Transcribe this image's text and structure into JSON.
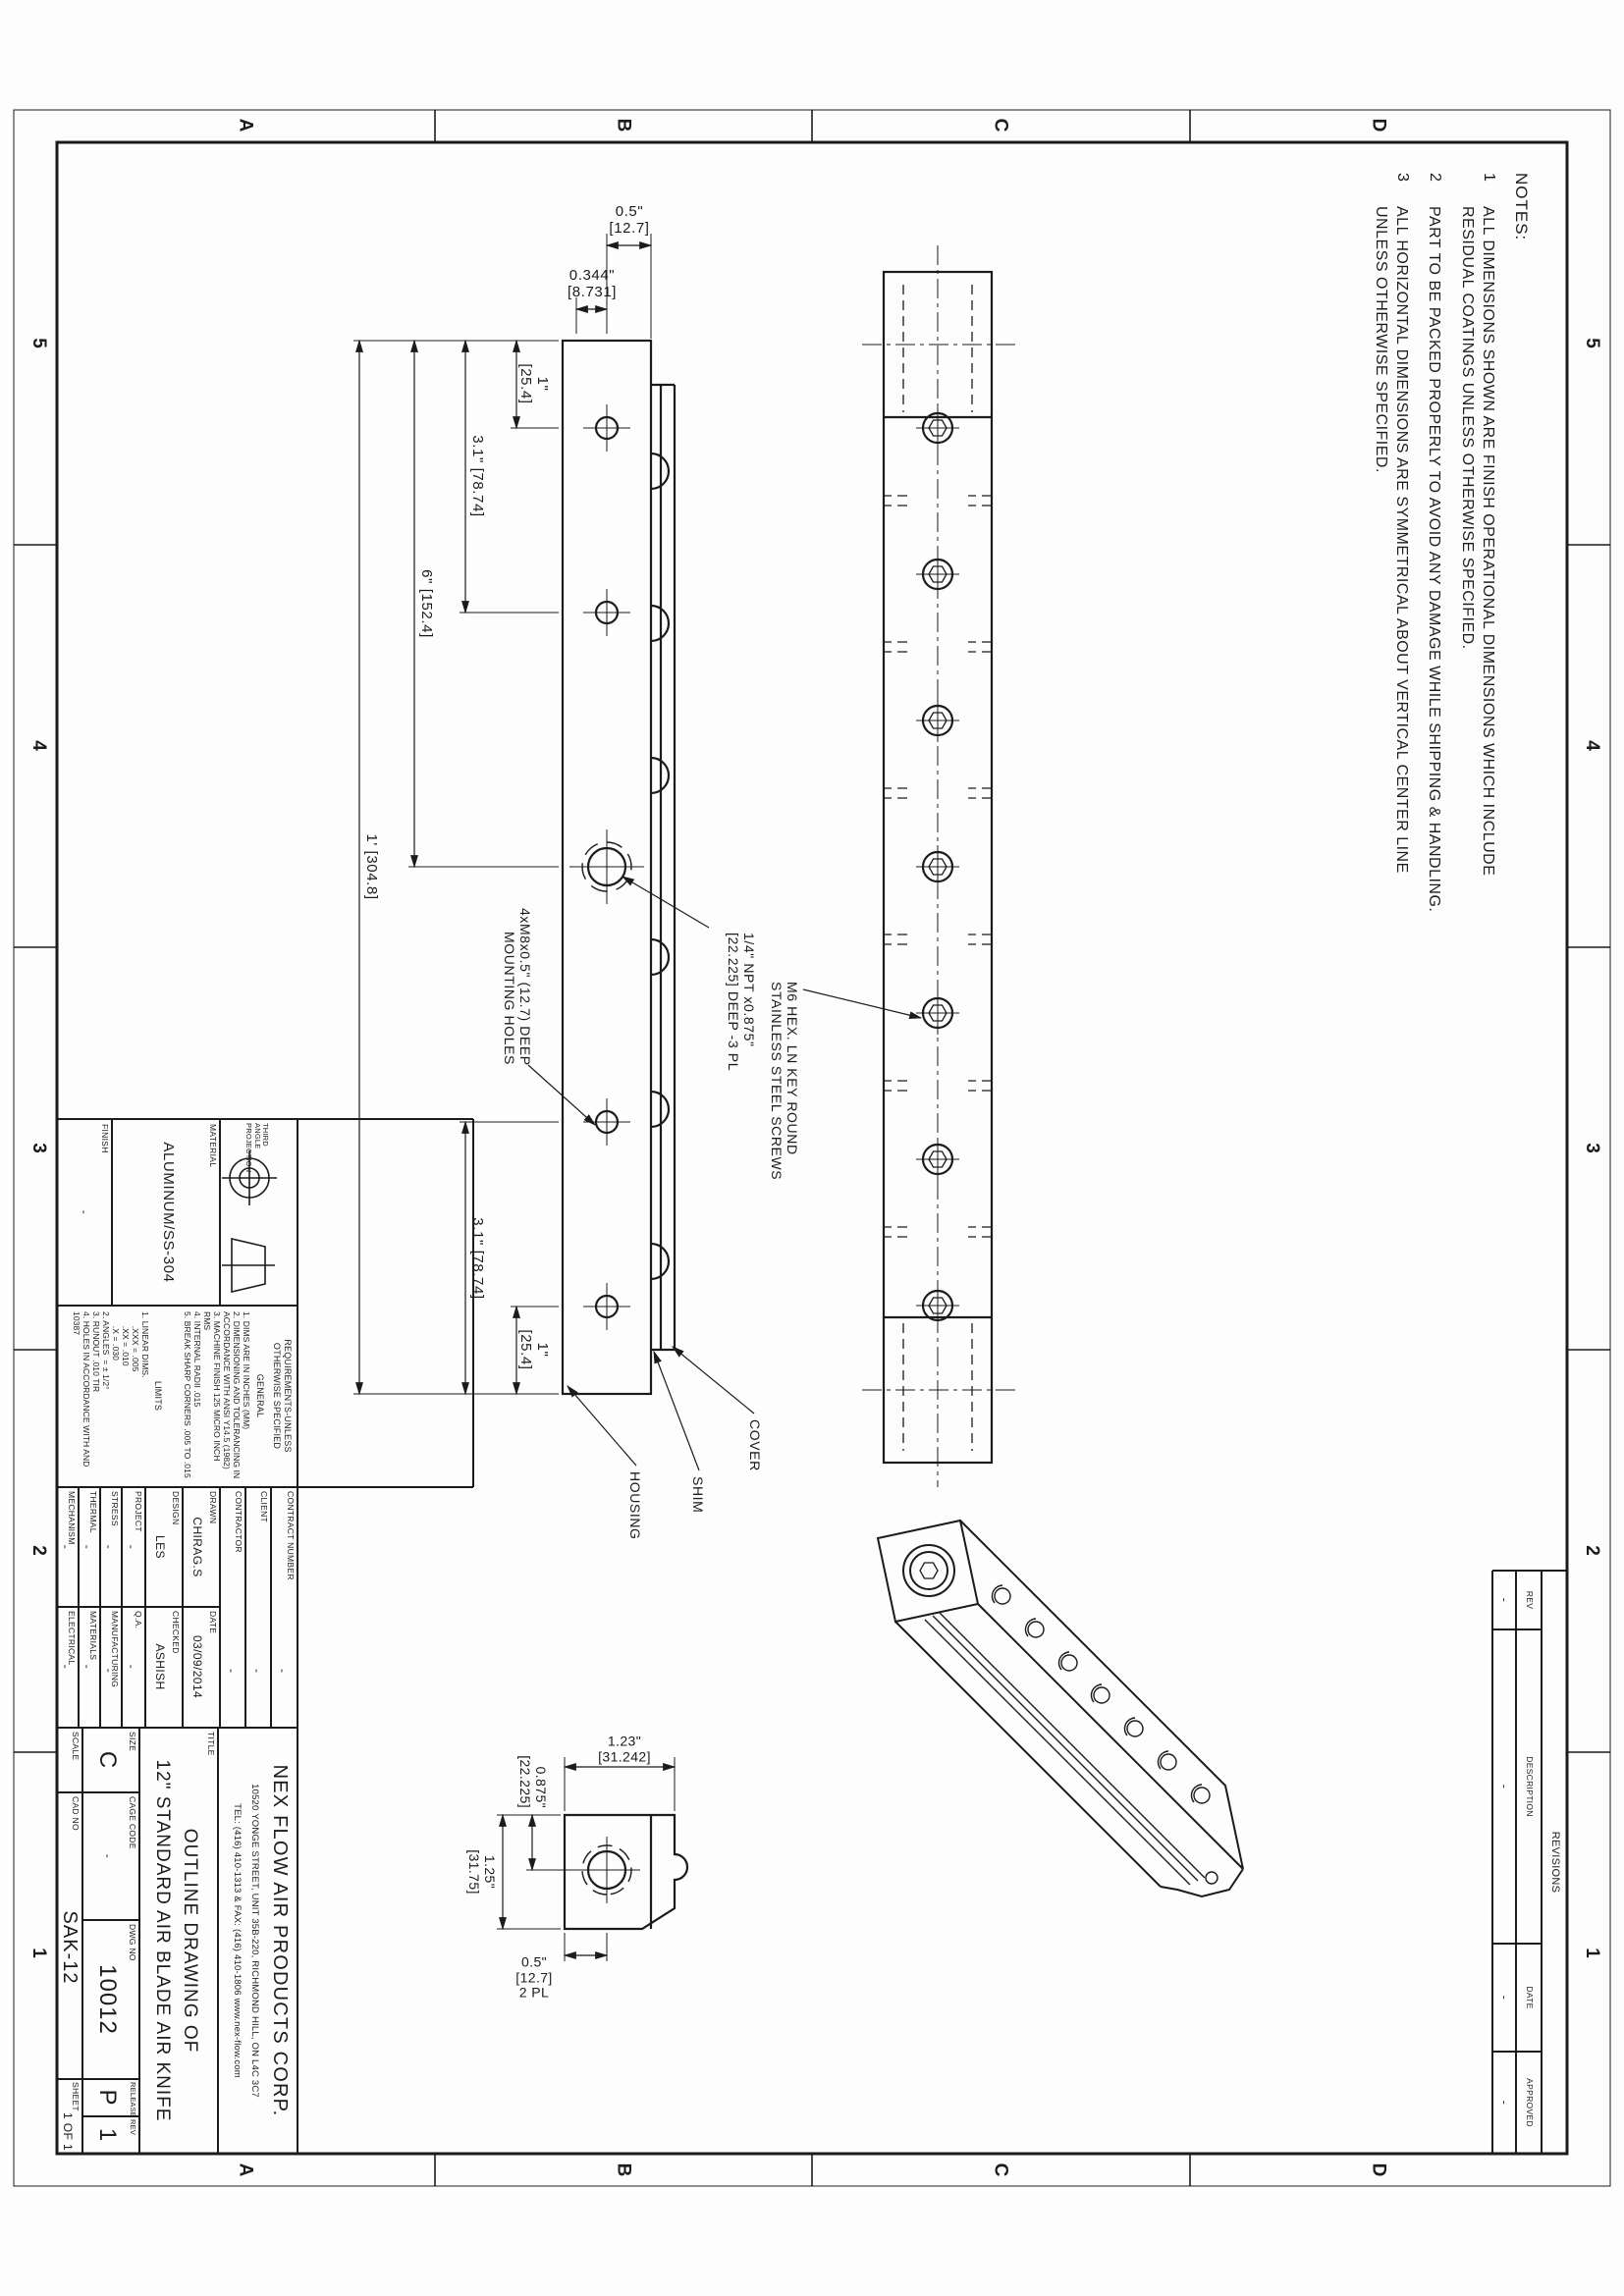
{
  "sheet": {
    "zone_columns": [
      "5",
      "4",
      "3",
      "2",
      "1"
    ],
    "zone_rows": [
      "D",
      "C",
      "B",
      "A"
    ]
  },
  "notes": {
    "title": "NOTES:",
    "items": [
      {
        "num": "1",
        "line1": "ALL DIMENSIONS SHOWN ARE FINISH OPERATIONAL DIMENSIONS WHICH INCLUDE",
        "line2": "RESIDUAL COATINGS UNLESS OTHERWISE SPECIFIED."
      },
      {
        "num": "2",
        "line1": "PART TO BE PACKED PROPERLY TO AVOID ANY DAMAGE WHILE SHIPPING & HANDLING.",
        "line2": ""
      },
      {
        "num": "3",
        "line1": "ALL HORIZONTAL DIMENSIONS ARE SYMMETRICAL ABOUT VERTICAL CENTER LINE",
        "line2": "UNLESS OTHERWISE SPECIFIED."
      }
    ]
  },
  "front_view": {
    "dims": {
      "one_a": "1\"",
      "one_b": "[25.4]",
      "three_one": "3.1\" [78.74]",
      "six": "6\" [152.4]",
      "foot": "1' [304.8]",
      "half_a": "0.5\"",
      "half_b": "[12.7]",
      "p344_a": "0.344\"",
      "p344_b": "[8.731]"
    },
    "labels": {
      "npt_1": "1/4\" NPT x0.875\"",
      "npt_2": "[22.225] DEEP -3 PL",
      "m8_1": "4xM8x0.5\" (12.7) DEEP",
      "m8_2": "MOUNTING HOLES",
      "cover": "COVER",
      "shim": "SHIM",
      "housing": "HOUSING"
    }
  },
  "top_view": {
    "labels": {
      "m6_1": "M6 HEX. LN KEY ROUND",
      "m6_2": "STAINLESS STEEL SCREWS"
    }
  },
  "side_view": {
    "dims": {
      "w_a": "1.23\"",
      "w_b": "[31.242]",
      "h1_a": "0.875\"",
      "h1_b": "[22.225]",
      "h2_a": "1.25\"",
      "h2_b": "[31.75]",
      "c_a": "0.5\"",
      "c_b": "[12.7]",
      "c_c": "2 PL"
    }
  },
  "title_block": {
    "projection_label_1": "THIRD ANGLE",
    "projection_label_2": "PROJECTION",
    "material_label": "MATERIAL",
    "material_value": "ALUMINUM/SS-304",
    "finish_label": "FINISH",
    "finish_value": "-",
    "requirements": {
      "header_1": "REQUIREMENTS-UNLESS",
      "header_2": "OTHERWISE SPECIFIED",
      "general_heading": "GENERAL",
      "general_items": [
        "1. DIMS ARE IN INCHES (MM)",
        "2. DIMENSIONING AND TOLERANCING IN ACCORDANCE WITH ANSI Y14.5 (1982)",
        "3. MACHINE FINISH 125 MICRO INCH RMS",
        "4. INTERNAL RADII .015",
        "5. BREAK SHARP CORNERS .005 TO .015"
      ],
      "limits_heading": "LIMITS",
      "limits_items": [
        "1. LINEAR DIMS.",
        "      .XXX = .005",
        "      .XX = .010",
        "      .X = .030",
        "2. ANGLES  = ± 1/2°",
        "3. RUNOUT .010 TIR",
        "4. HOLES IN ACCORDANCE WITH AND 10387"
      ]
    },
    "admin": {
      "contract_label": "CONTRACT NUMBER",
      "contract_value": "-",
      "client_label": "CLIENT",
      "client_value": "-",
      "contractor_label": "CONTRACTOR",
      "contractor_value": "-",
      "drawn_label": "DRAWN",
      "drawn_value": "CHIRAG.S",
      "date_label": "DATE",
      "date_value": "03/09/2014",
      "design_label": "DESIGN",
      "design_value": "LES",
      "checked_label": "CHECKED",
      "checked_value": "ASHISH",
      "project_label": "PROJECT",
      "project_value": "-",
      "qa_label": "Q.A.",
      "qa_value": "-",
      "stress_label": "STRESS",
      "stress_value": "-",
      "manufacturing_label": "MANUFACTURING",
      "manufacturing_value": "-",
      "thermal_label": "THERMAL",
      "thermal_value": "-",
      "materials_label": "MATERIALS",
      "materials_value": "-",
      "mechanism_label": "MECHANISM",
      "mechanism_value": "-",
      "electrical_label": "ELECTRICAL",
      "electrical_value": "-"
    },
    "company": {
      "name": "NEX FLOW AIR PRODUCTS CORP.",
      "address": "10520 YONGE STREET, UNIT 35B-220, RICHMOND HILL, ON L4C 3C7",
      "tel": "TEL: (416) 410-1313 & FAX: (416) 410-1806  www.nex-flow.com"
    },
    "title_label": "TITLE",
    "title_line1": "OUTLINE DRAWING OF",
    "title_line2": "12\" STANDARD AIR BLADE AIR KNIFE",
    "size_label": "SIZE",
    "size_value": "C",
    "cage_label": "CAGE CODE",
    "cage_value": "-",
    "dwg_label": "DWG NO",
    "dwg_value": "10012",
    "release_label": "RELEASE",
    "release_value": "P",
    "rev_label": "REV",
    "rev_value": "1",
    "scale_label": "SCALE",
    "cad_label": "CAD NO",
    "cad_value": "SAK-12",
    "sheet_label": "SHEET",
    "sheet_value": "1 OF 1"
  },
  "revisions": {
    "title": "REVISIONS",
    "headers": [
      "REV",
      "DESCRIPTION",
      "DATE",
      "APPROVED"
    ],
    "row": [
      "-",
      "-",
      "-",
      "-"
    ]
  }
}
